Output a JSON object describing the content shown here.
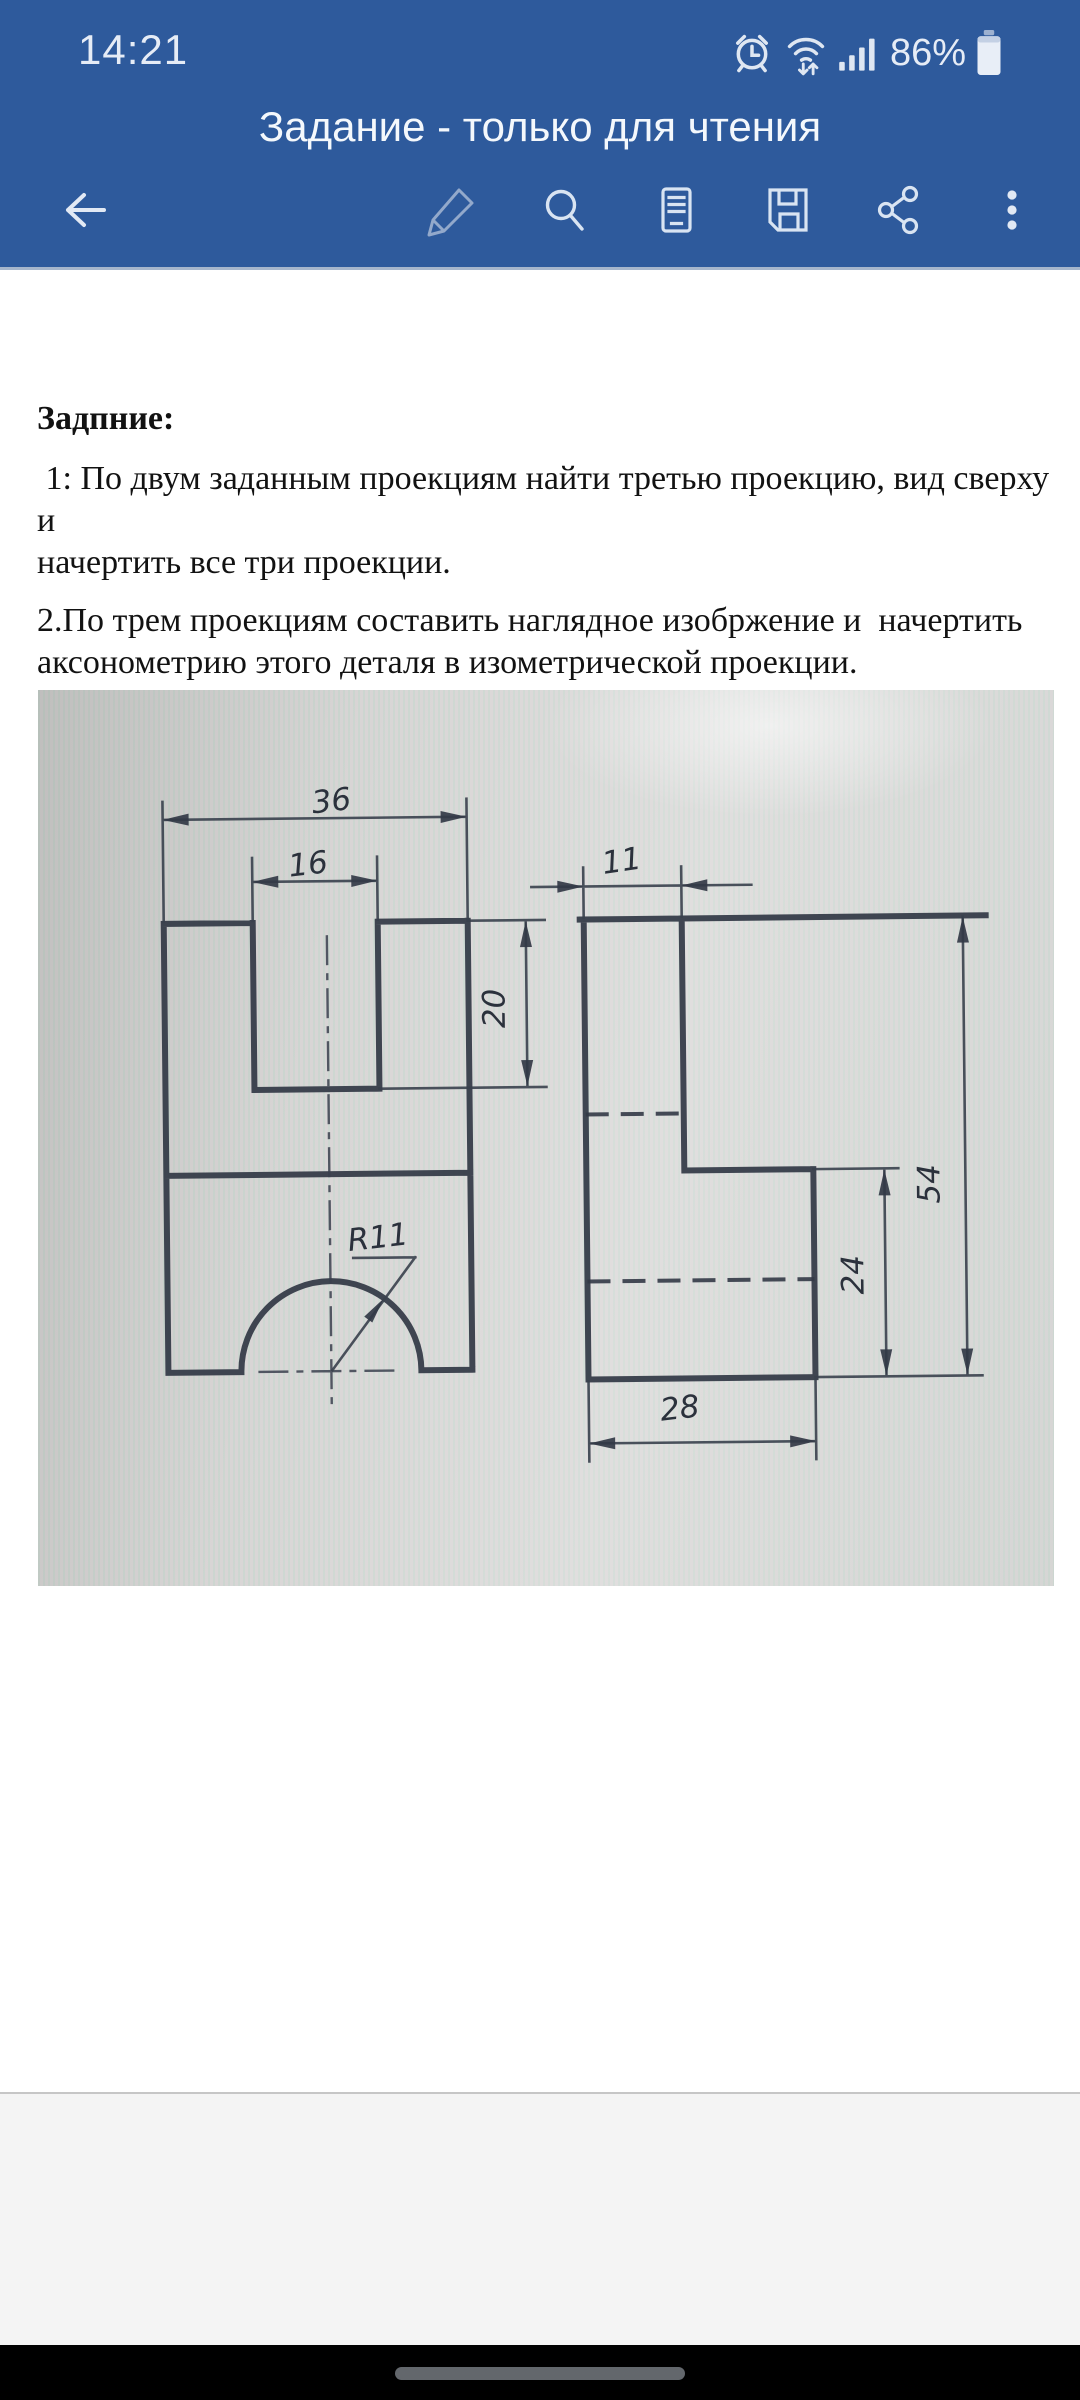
{
  "status_bar": {
    "time": "14:21",
    "battery_percent": "86%",
    "icons": [
      "alarm-icon",
      "wifi-data-icon",
      "signal-bars-icon",
      "battery-icon"
    ]
  },
  "header": {
    "title": "Задание - только для чтения"
  },
  "toolbar": {
    "icons": [
      "back-arrow",
      "edit-pencil",
      "search",
      "mobile-view",
      "save-floppy",
      "share",
      "overflow-menu"
    ]
  },
  "document": {
    "heading": "Задпние:",
    "p1": [
      " 1: По двум заданным проекциям найти третью проекцию, вид сверху и",
      "начертить все три проекции."
    ],
    "p2": [
      "2.По трем проекциям составить наглядное изобржение и  начертить",
      "аксонометрию этого деталя в изометрической проекции."
    ]
  },
  "drawing": {
    "front_view": {
      "width_top": "36",
      "notch_width": "16",
      "notch_depth": "20",
      "arc_radius": "R11"
    },
    "side_view": {
      "top_depth": "11",
      "overall_height": "54",
      "step_height": "24",
      "base_depth": "28"
    }
  }
}
